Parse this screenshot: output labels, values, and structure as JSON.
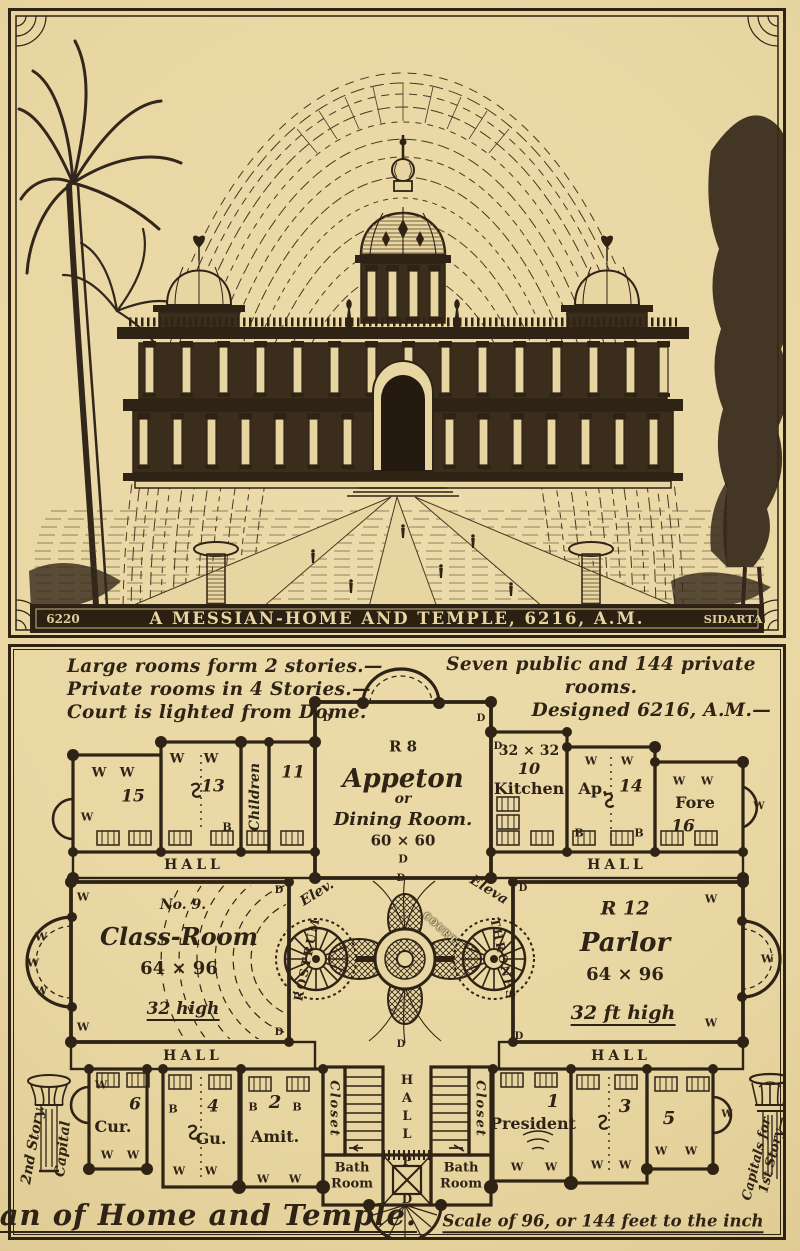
{
  "page": {
    "paper": "#e8d6a2",
    "ink": "#2f2315"
  },
  "banner": {
    "left_code": "6220",
    "title": "A MESSIAN-HOME AND TEMPLE, 6216, A.M.",
    "right_code": "SIDARTA"
  },
  "notes": {
    "l1": "Large rooms form 2 stories.—",
    "l2": "Private rooms in 4 Stories.—",
    "l3": "Court is lighted from Dome.",
    "r1": "Seven public and 144 private",
    "r2": "rooms.",
    "r3": "Designed 6216, A.M.—"
  },
  "markers": {
    "w": "W",
    "b": "B",
    "d": "D",
    "hall": "HALL"
  },
  "rooms": {
    "r15": "15",
    "r13": "13",
    "r11": "11",
    "children": "Children",
    "appeton_r": "R 8",
    "appeton_name": "Appeton",
    "appeton_or": "or",
    "appeton_type": "Dining Room.",
    "appeton_dims": "60 × 60",
    "kitchen_dims": "32 × 32",
    "kitchen_no": "10",
    "kitchen": "Kitchen",
    "ap": "Ap.",
    "ap_no": "14",
    "fore": "Fore",
    "fore_no": "16",
    "class_no": "No. 9.",
    "class_name": "Class-Room",
    "class_dims": "64 × 96",
    "class_height": "32 high",
    "rostrum": "ROSTRUM",
    "court": "COURT",
    "thrones": "THRONES",
    "elev_l": "Elev.",
    "elev_r": "Eleva",
    "parlor_r": "R 12",
    "parlor_name": "Parlor",
    "parlor_dims": "64 × 96",
    "parlor_height": "32 ft high",
    "cur": "Cur.",
    "cur_no": "6",
    "gu": "Gu.",
    "gu_no": "4",
    "amit": "Amit.",
    "amit_no": "2",
    "president": "President",
    "president_no": "1",
    "r3": "3",
    "r5": "5",
    "closet": "Closet",
    "bath1": "Bath",
    "bath2": "Room",
    "porch_p": "P",
    "porch_d": "D"
  },
  "side": {
    "capital": "Capital",
    "story2": "2nd Story.",
    "capitals1": "Capitals for",
    "capitals2": "1st Story—"
  },
  "caption": {
    "title": "Plan of Home and Temple.",
    "scale": "Scale of 96, or 144 feet to the inch"
  }
}
